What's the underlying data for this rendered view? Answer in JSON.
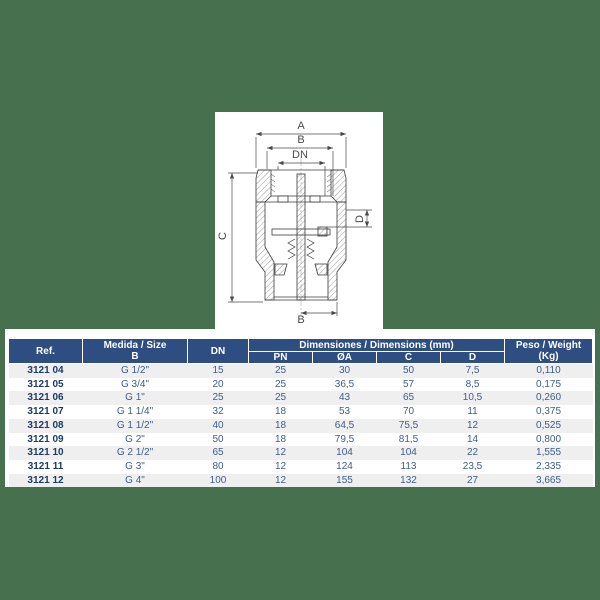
{
  "colors": {
    "page_background": "#47714E",
    "table_header_blue": "#2E4D80",
    "row_alt_gray": "#EFEFEF",
    "ref_text_navy": "#1E3A66",
    "cell_text_blue": "#3F5C8C"
  },
  "diagram": {
    "dim_a": "A",
    "dim_b_top": "B",
    "dim_dn": "DN",
    "dim_c": "C",
    "dim_d": "D",
    "dim_b_bottom": "B"
  },
  "table": {
    "header": {
      "ref": "Ref.",
      "size_line1": "Medida / Size",
      "size_line2": "B",
      "dn": "DN",
      "dimensions_group": "Dimensiones / Dimensions (mm)",
      "pn": "PN",
      "oa": "ØA",
      "c": "C",
      "d": "D",
      "weight_line1": "Peso / Weight",
      "weight_line2": "(Kg)"
    },
    "rows": [
      {
        "ref": "3121 04",
        "size": "G 1/2\"",
        "dn": "15",
        "pn": "25",
        "da": "30",
        "c": "50",
        "d": "7,5",
        "kg": "0,110"
      },
      {
        "ref": "3121 05",
        "size": "G 3/4\"",
        "dn": "20",
        "pn": "25",
        "da": "36,5",
        "c": "57",
        "d": "8,5",
        "kg": "0,175"
      },
      {
        "ref": "3121 06",
        "size": "G 1\"",
        "dn": "25",
        "pn": "25",
        "da": "43",
        "c": "65",
        "d": "10,5",
        "kg": "0,260"
      },
      {
        "ref": "3121 07",
        "size": "G 1 1/4\"",
        "dn": "32",
        "pn": "18",
        "da": "53",
        "c": "70",
        "d": "11",
        "kg": "0,375"
      },
      {
        "ref": "3121 08",
        "size": "G 1 1/2\"",
        "dn": "40",
        "pn": "18",
        "da": "64,5",
        "c": "75,5",
        "d": "12",
        "kg": "0,525"
      },
      {
        "ref": "3121 09",
        "size": "G 2\"",
        "dn": "50",
        "pn": "18",
        "da": "79,5",
        "c": "81,5",
        "d": "14",
        "kg": "0,800"
      },
      {
        "ref": "3121 10",
        "size": "G 2 1/2\"",
        "dn": "65",
        "pn": "12",
        "da": "104",
        "c": "104",
        "d": "22",
        "kg": "1,555"
      },
      {
        "ref": "3121 11",
        "size": "G 3\"",
        "dn": "80",
        "pn": "12",
        "da": "124",
        "c": "113",
        "d": "23,5",
        "kg": "2,335"
      },
      {
        "ref": "3121 12",
        "size": "G 4\"",
        "dn": "100",
        "pn": "12",
        "da": "155",
        "c": "132",
        "d": "27",
        "kg": "3,665"
      }
    ]
  }
}
